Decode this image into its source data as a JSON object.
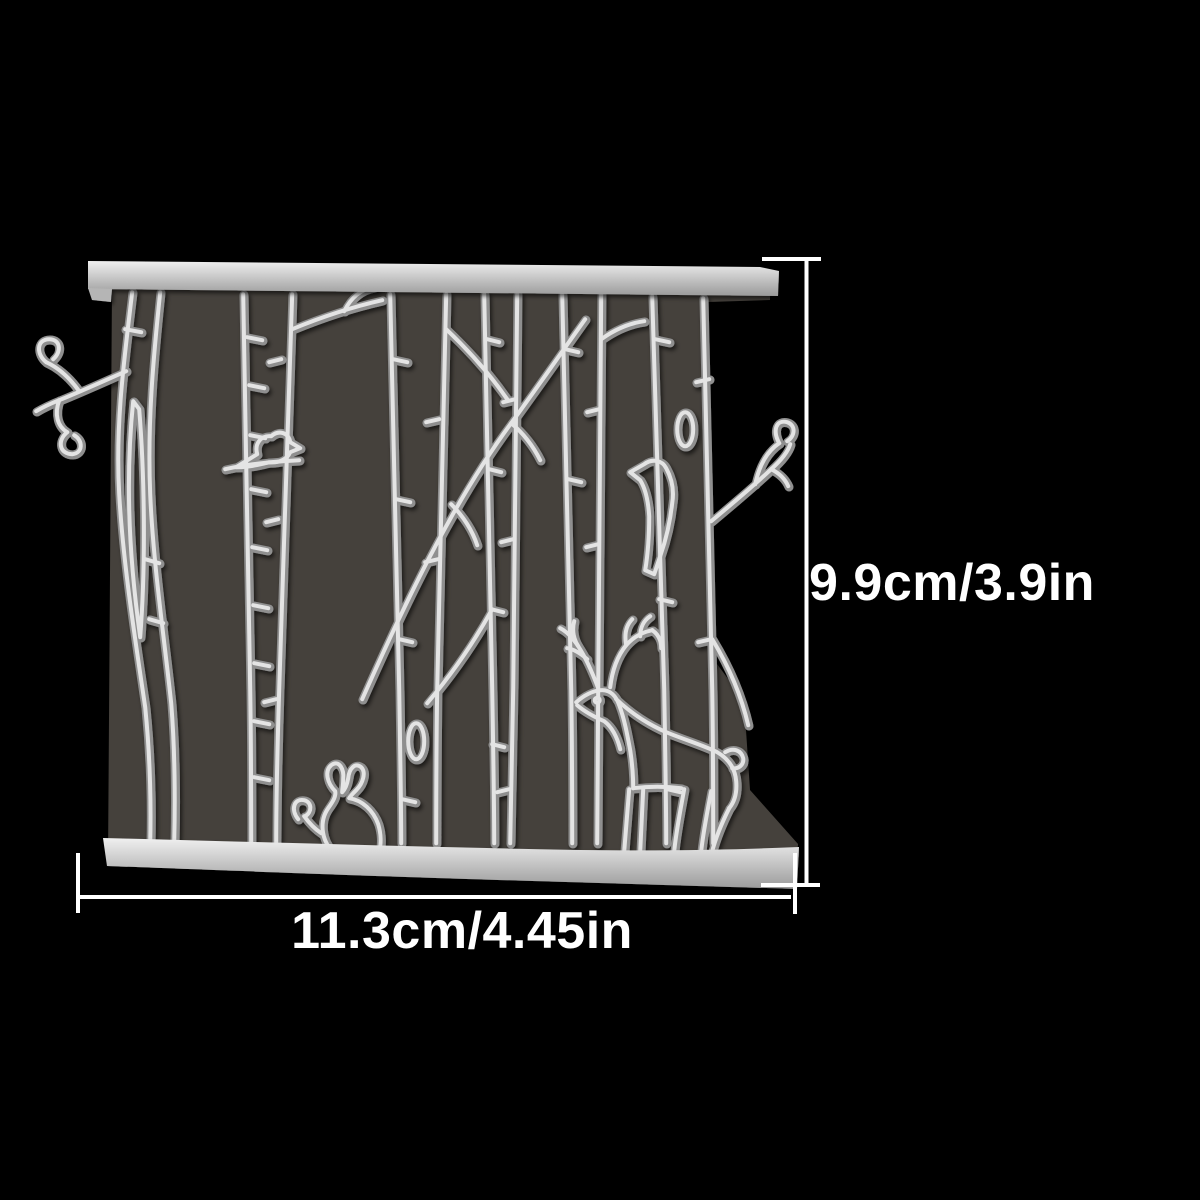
{
  "page": {
    "background_color": "#000000"
  },
  "annotations": {
    "height_label": "9.9cm/3.9in",
    "width_label": "11.3cm/4.45in",
    "line_color": "#ffffff",
    "text_color": "#ffffff"
  },
  "die": {
    "subject": "birch tree forest cutting die with deer, rabbit and birds",
    "metal_color": "#cfcfcf",
    "metal_highlight": "#e9e9e9",
    "metal_shadow": "#8f8f8f",
    "backing_color": "#45413c",
    "elements": [
      "top-rail",
      "bottom-rail",
      "birch-trunks",
      "branches",
      "heart-leaves",
      "deer",
      "rabbit",
      "bird-small",
      "bird-perched"
    ]
  }
}
